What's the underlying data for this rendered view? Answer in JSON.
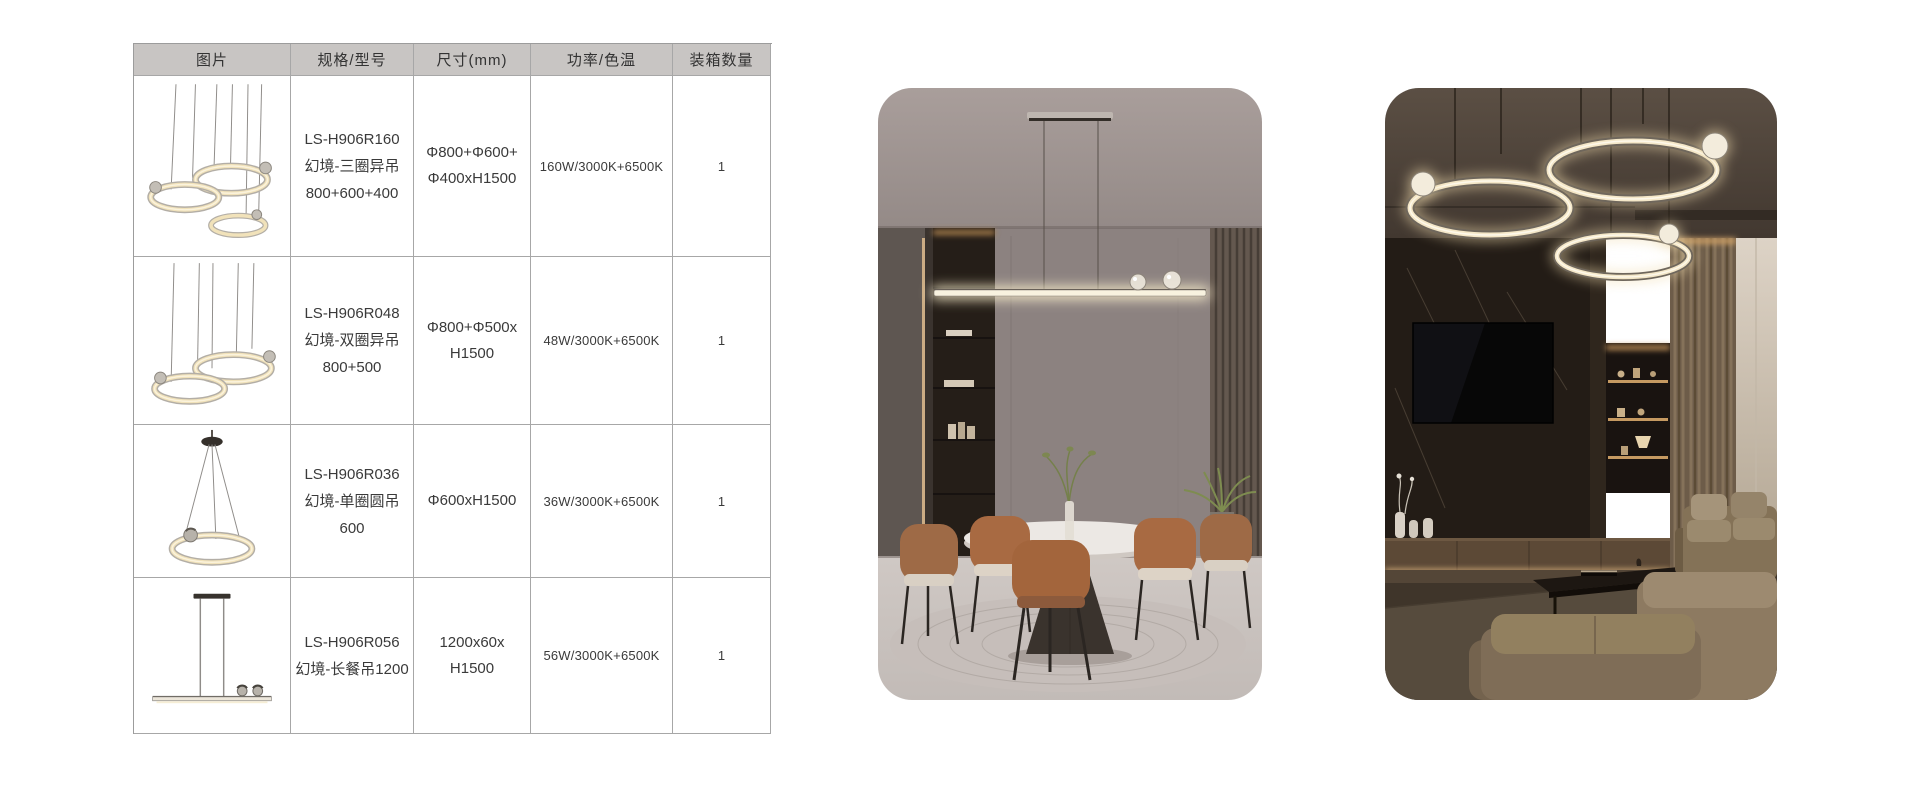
{
  "table": {
    "headers": [
      "图片",
      "规格/型号",
      "尺寸(mm)",
      "功率/色温",
      "装箱数量"
    ],
    "rows": [
      {
        "image": "three-ring-pendant",
        "spec_lines": [
          "LS-H906R160",
          "幻境-三圈异吊",
          "800+600+400"
        ],
        "size_lines": [
          "Φ800+Φ600+",
          "Φ400xH1500"
        ],
        "power": "160W/3000K+6500K",
        "qty": "1"
      },
      {
        "image": "two-ring-pendant",
        "spec_lines": [
          "LS-H906R048",
          "幻境-双圈异吊",
          "800+500"
        ],
        "size_lines": [
          "Φ800+Φ500x",
          "H1500"
        ],
        "power": "48W/3000K+6500K",
        "qty": "1"
      },
      {
        "image": "single-ring-pendant",
        "spec_lines": [
          "LS-H906R036",
          "幻境-单圈圆吊",
          "600"
        ],
        "size_lines": [
          "Φ600xH1500"
        ],
        "power": "36W/3000K+6500K",
        "qty": "1"
      },
      {
        "image": "linear-bar-pendant",
        "spec_lines": [
          "LS-H906R056",
          "幻境-长餐吊1200"
        ],
        "size_lines": [
          "1200x60x",
          "H1500"
        ],
        "power": "56W/3000K+6500K",
        "qty": "1"
      }
    ]
  },
  "photos": {
    "dining": "dining-room-with-linear-pendant",
    "living": "living-room-with-ring-pendants"
  },
  "colors": {
    "header_bg": "#c8c5c3",
    "table_border": "#a7a7a7",
    "led_glow": "#f2e3bd"
  }
}
